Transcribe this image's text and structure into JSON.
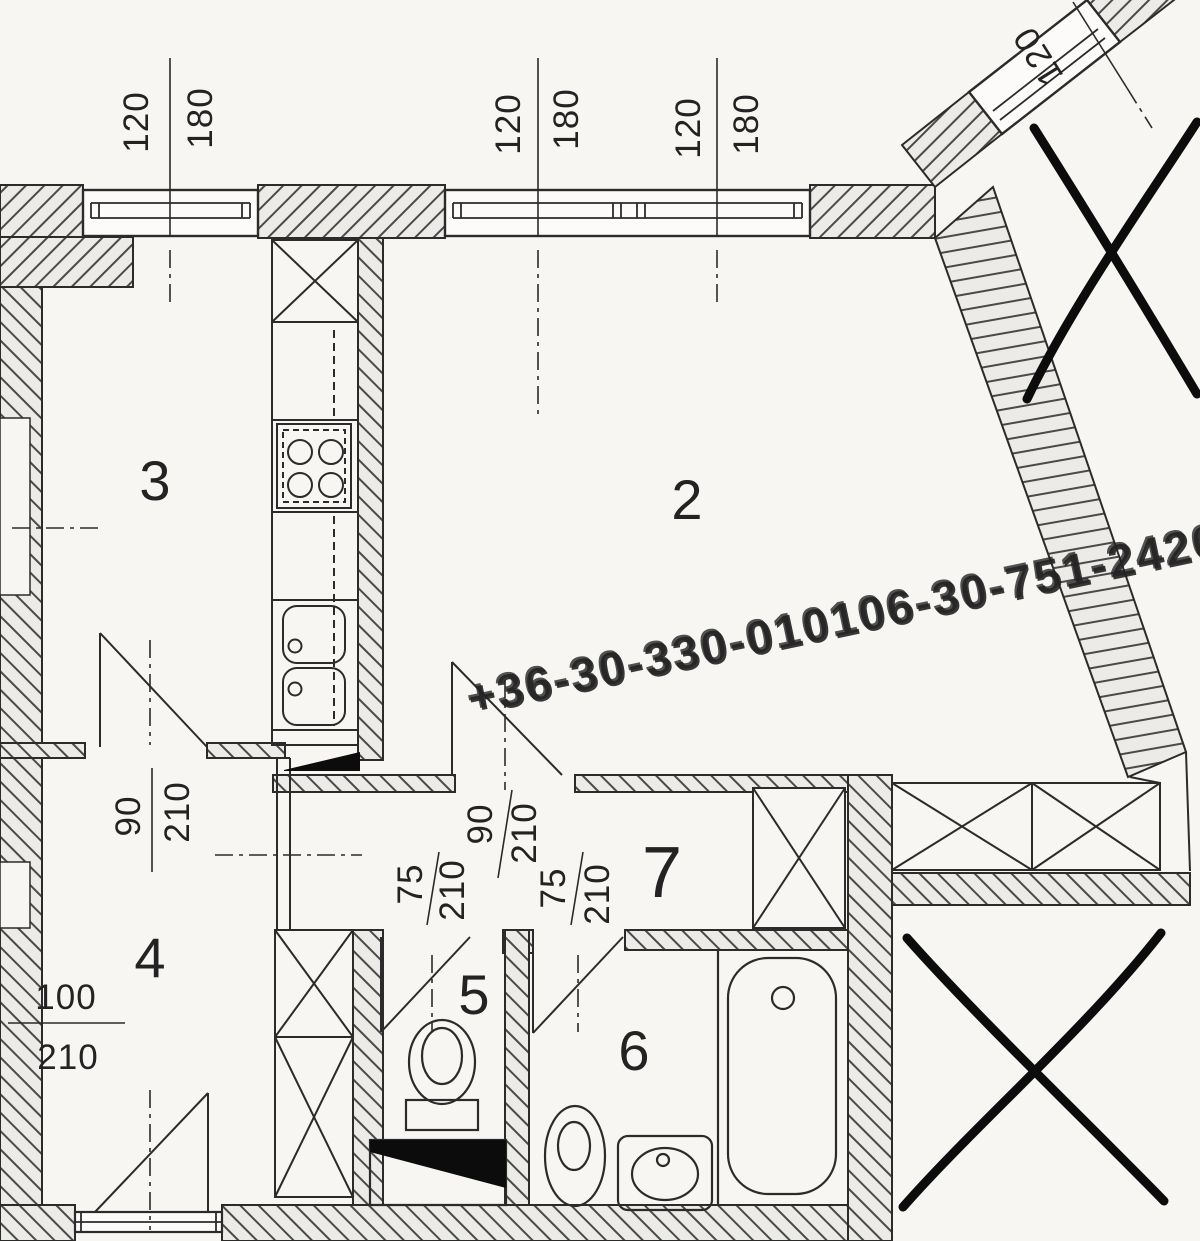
{
  "plan_title": "apartment-floor-plan",
  "watermark": {
    "text": "+36-30-330-010106-30-751-2420"
  },
  "rooms": {
    "living": {
      "label": "2"
    },
    "kitchen": {
      "label": "3"
    },
    "bedroom": {
      "label": "4"
    },
    "wc": {
      "label": "5"
    },
    "bathroom": {
      "label": "6"
    },
    "hall": {
      "label": "7"
    }
  },
  "windows": {
    "left": {
      "w": "120",
      "h": "180"
    },
    "mid": {
      "w": "120",
      "h": "180"
    },
    "right": {
      "w": "120",
      "h": "180"
    },
    "diagonal": {
      "w": "120"
    }
  },
  "doors": {
    "kitchen": {
      "w": "90",
      "h": "210"
    },
    "living": {
      "w": "90",
      "h": "210"
    },
    "wc": {
      "w": "75",
      "h": "210"
    },
    "bathroom": {
      "w": "75",
      "h": "210"
    },
    "bedroom": {
      "w": "100",
      "h": "210"
    }
  },
  "colors": {
    "paper": "#f7f6f3",
    "line": "#2b2b2b",
    "wall_fill": "#edebe7",
    "watermark": "#b9b8b6",
    "annotation": "#0c0c0c"
  }
}
